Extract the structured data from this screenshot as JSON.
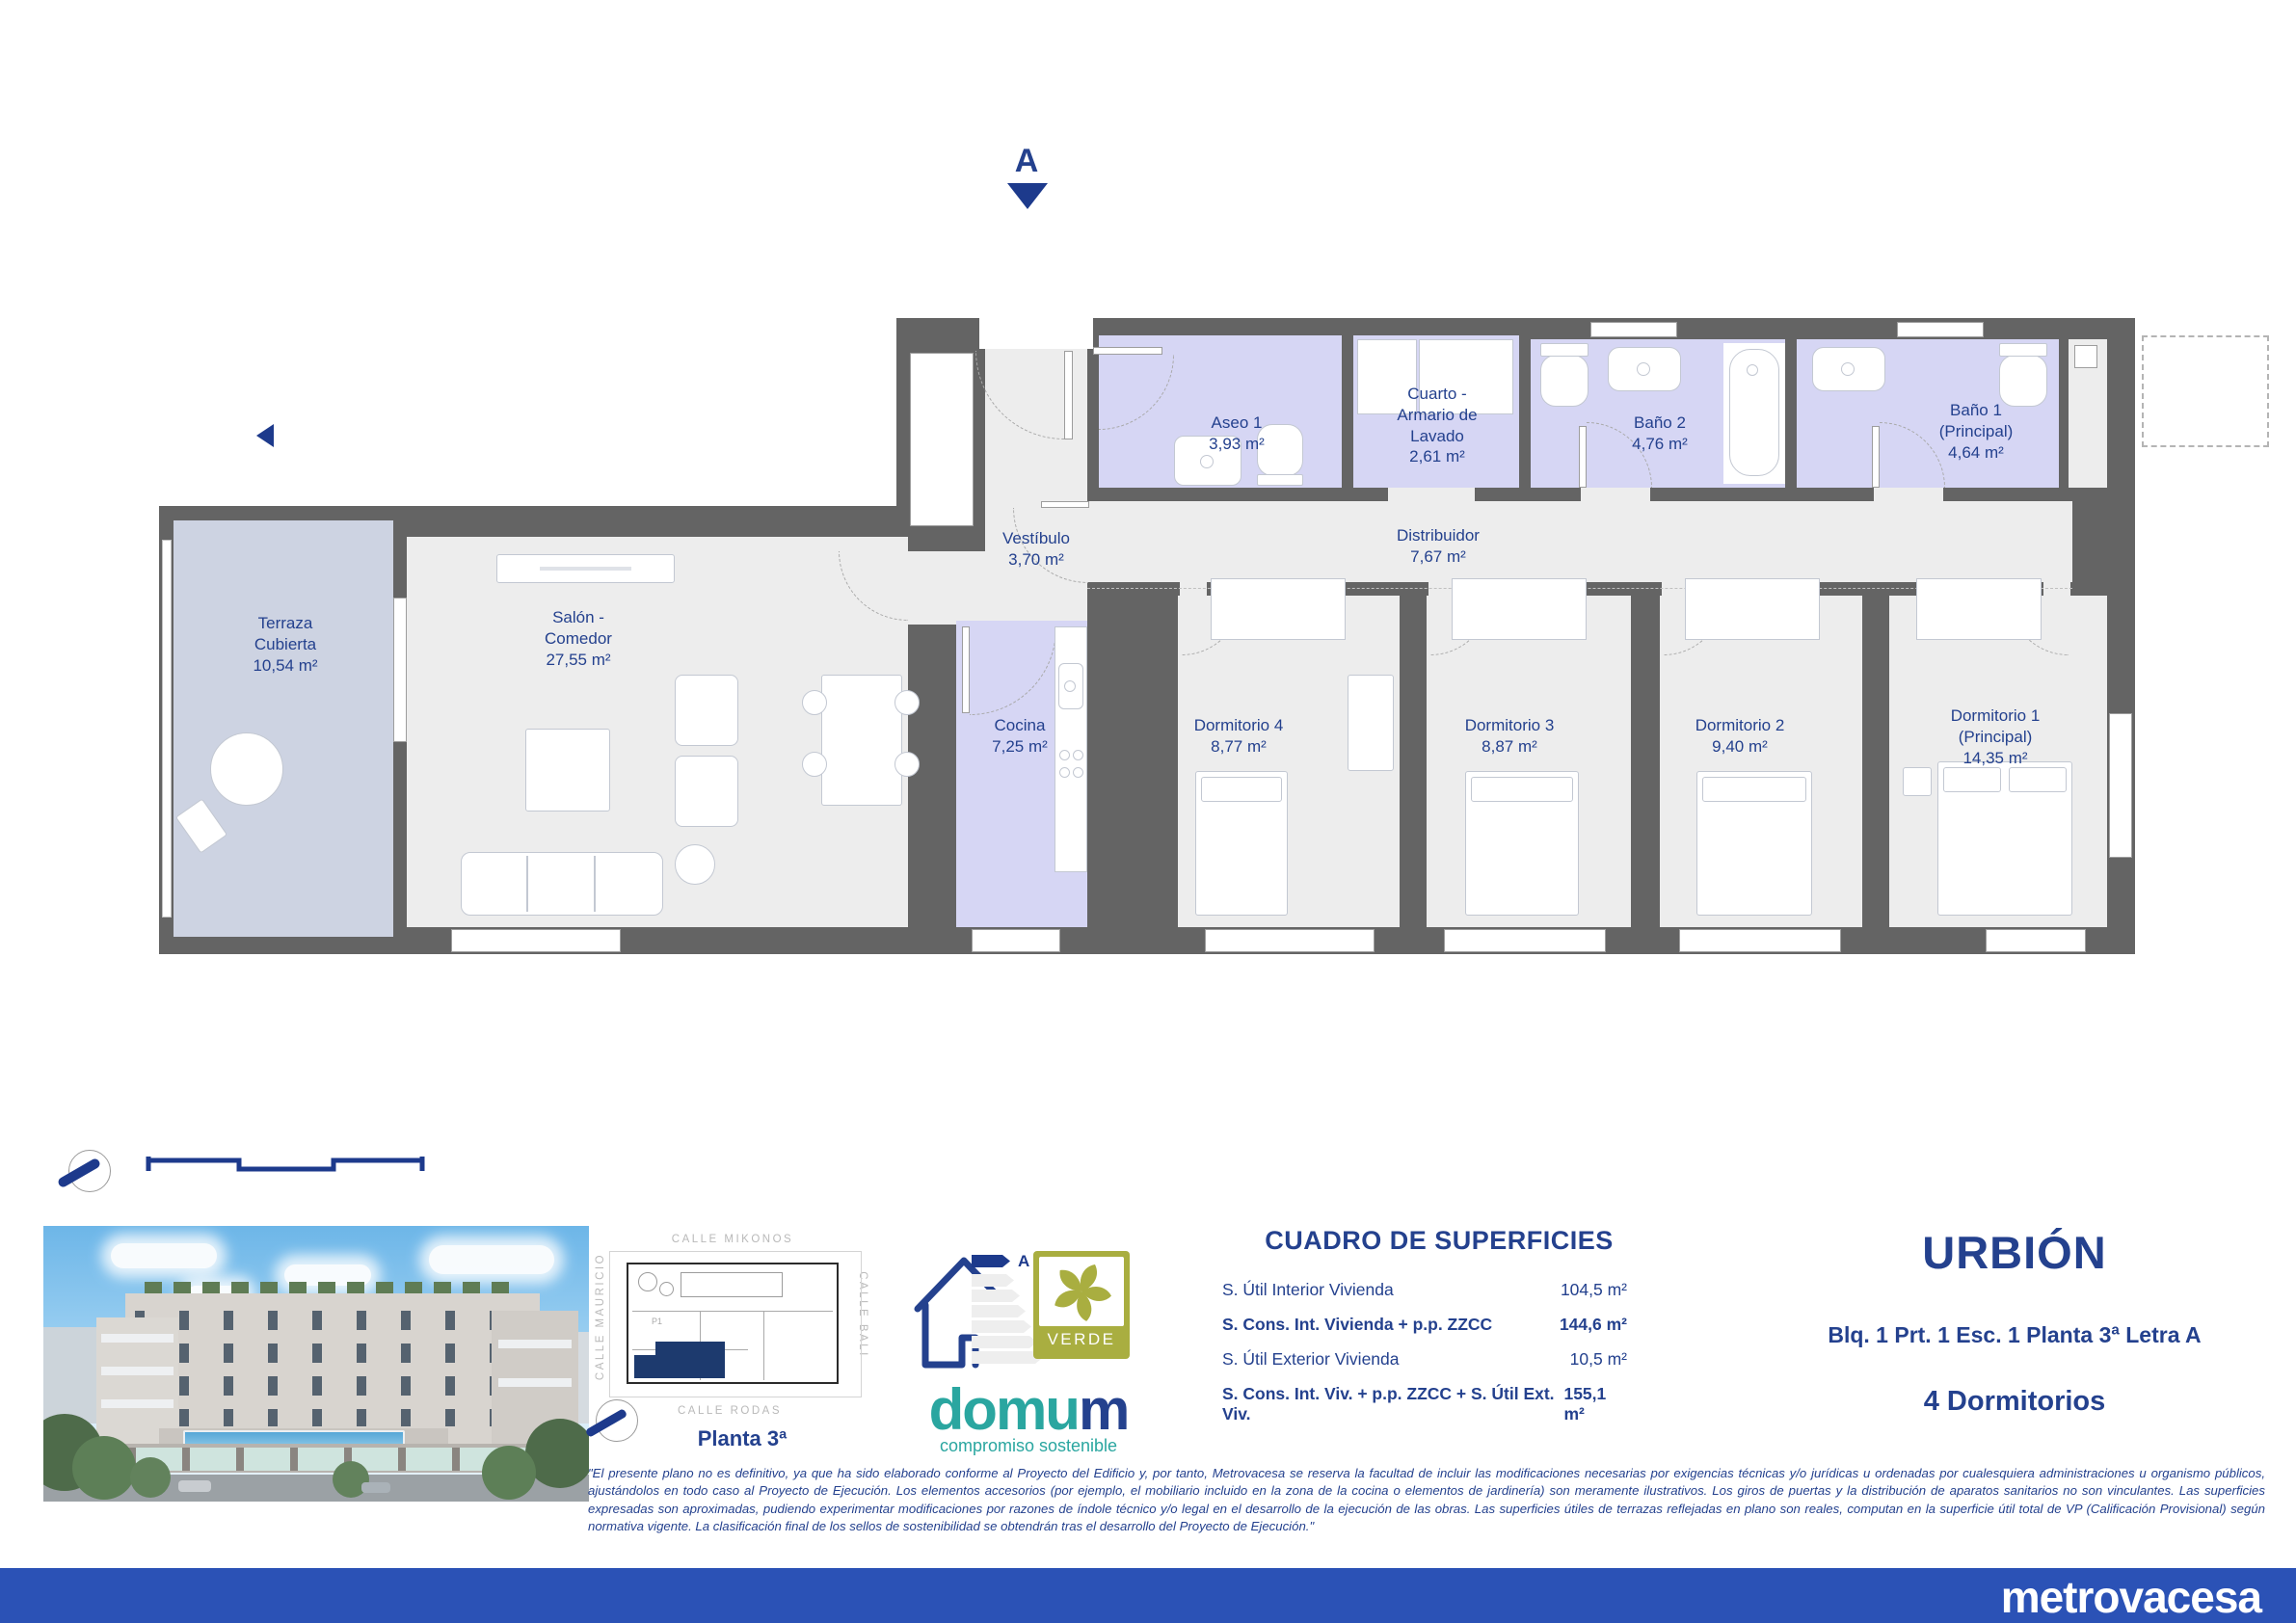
{
  "plan": {
    "section_label": "A",
    "rooms": [
      {
        "name": "Terraza Cubierta",
        "area": "10,54 m²"
      },
      {
        "name": "Salón - Comedor",
        "area": "27,55 m²"
      },
      {
        "name": "Vestíbulo",
        "area": "3,70 m²"
      },
      {
        "name": "Aseo 1",
        "area": "3,93 m²"
      },
      {
        "name": "Cuarto - Armario de Lavado",
        "area": "2,61 m²"
      },
      {
        "name": "Baño 2",
        "area": "4,76 m²"
      },
      {
        "name": "Baño 1 (Principal)",
        "area": "4,64 m²"
      },
      {
        "name": "Distribuidor",
        "area": "7,67 m²"
      },
      {
        "name": "Cocina",
        "area": "7,25 m²"
      },
      {
        "name": "Dormitorio 4",
        "area": "8,77 m²"
      },
      {
        "name": "Dormitorio 3",
        "area": "8,87 m²"
      },
      {
        "name": "Dormitorio 2",
        "area": "9,40 m²"
      },
      {
        "name": "Dormitorio 1 (Principal)",
        "area": "14,35 m²"
      }
    ]
  },
  "site_plan": {
    "street_top": "CALLE MIKONOS",
    "street_left": "CALLE MAURICIO",
    "street_right": "CALLE BALI",
    "street_bottom": "CALLE RODAS",
    "floor_label": "Planta 3ª",
    "unit_tag": "P1"
  },
  "certifications": {
    "energy_letter": "A",
    "verde_label": "VERDE",
    "brand_main": "domu",
    "brand_suffix": "m",
    "tagline": "compromiso sostenible"
  },
  "surfaces": {
    "title": "CUADRO DE SUPERFICIES",
    "rows": [
      {
        "label": "S. Útil Interior Vivienda",
        "value": "104,5 m²"
      },
      {
        "label": "S. Cons. Int. Vivienda + p.p. ZZCC",
        "value": "144,6 m²"
      },
      {
        "label": "S. Útil Exterior Vivienda",
        "value": "10,5 m²"
      },
      {
        "label": "S. Cons. Int. Viv. + p.p. ZZCC + S. Útil Ext. Viv.",
        "value": "155,1 m²"
      }
    ]
  },
  "unit": {
    "project": "URBIÓN",
    "location": "Blq. 1 Prt. 1 Esc. 1 Planta 3ª Letra A",
    "type": "4 Dormitorios"
  },
  "disclaimer": "\"El presente plano no es definitivo, ya que ha sido elaborado conforme al Proyecto del Edificio y, por tanto, Metrovacesa se reserva la facultad de incluir las modificaciones necesarias por exigencias técnicas y/o jurídicas u ordenadas por cualesquiera administraciones u organismo públicos, ajustándolos en todo caso al Proyecto de Ejecución. Los elementos accesorios (por ejemplo, el mobiliario incluido en la zona de la cocina o elementos de jardinería) son meramente ilustrativos. Los giros de puertas y la distribución de aparatos sanitarios no son vinculantes. Las superficies expresadas son aproximadas, pudiendo experimentar modificaciones por razones de índole técnico y/o legal en el desarrollo de la ejecución de las obras. Las superficies útiles de terrazas reflejadas en plano son reales, computan en la superficie útil total de VP (Calificación Provisional) según normativa vigente. La clasificación final de los sellos de sostenibilidad se obtendrán tras el desarrollo del Proyecto de Ejecución.\"",
  "footer": {
    "brand": "metrovacesa"
  },
  "colors": {
    "accent_blue": "#24418e",
    "footer_blue": "#2b52b6",
    "wet_room_fill": "#d6d6f4",
    "terrace_fill": "#cdd3e2",
    "wall_gray": "#646464",
    "verde_olive": "#a9ae40",
    "domum_teal": "#2aa6a0"
  }
}
